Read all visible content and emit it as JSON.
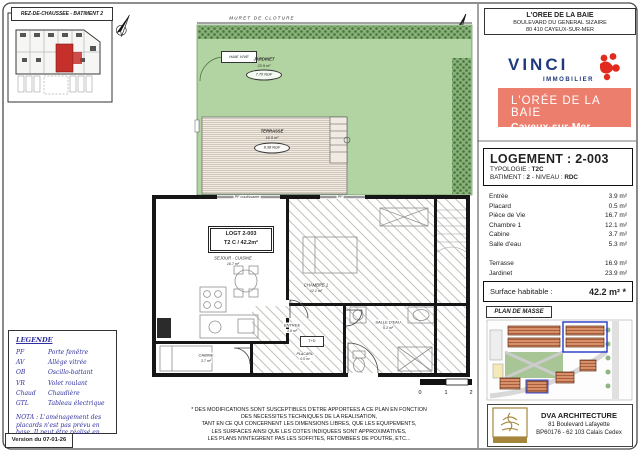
{
  "overview": {
    "title": "REZ-DE-CHAUSSEE - BATIMENT 2"
  },
  "header": {
    "address": {
      "line1": "L'OREE DE LA BAIE",
      "line2": "BOULEVARD DU GENERAL SIZAIRE",
      "line3": "80 410 CAYEUX-SUR-MER"
    },
    "vinci": {
      "name": "VINCI",
      "subtitle": "IMMOBILIER"
    },
    "banner": {
      "title": "L'ORÉE DE LA BAIE",
      "subtitle": "Cayeux-sur-Mer"
    }
  },
  "floorplan": {
    "muret": "MURET DE CLOTURE",
    "haie_vive": "HAIE VIVE",
    "jardinet": {
      "name": "JARDINET",
      "area": "23.9 m²",
      "ngf": "7.70 NGF"
    },
    "terrasse": {
      "name": "TERRASSE",
      "area": "16.9 m²",
      "ngf": "8.38 NGF"
    },
    "logt_box": {
      "line1": "LOGT 2-003",
      "line2": "T2 C / 42.2m²"
    },
    "sejour": {
      "name": "SEJOUR - CUISINE",
      "area": "16.7 m²"
    },
    "chambre": {
      "name": "CHAMBRE 1",
      "area": "12.1 m²"
    },
    "entree": {
      "name": "ENTREE",
      "area": "3.9 m²"
    },
    "placard": {
      "name": "PLACARD",
      "area": "0.5 m²"
    },
    "cabine": {
      "name": "CABINE",
      "area": "3.7 m²"
    },
    "salle_eau": {
      "name": "SALLE D'EAU",
      "area": "5.3 m²"
    },
    "tableau": "T+D",
    "pf_coulissante": "PF coulissante",
    "pf": "PF",
    "scale": [
      "0",
      "1",
      "2"
    ]
  },
  "logement": {
    "title": "LOGEMENT : 2-003",
    "typologie_label": "TYPOLOGIE : ",
    "typologie": "T2C",
    "batiment_label": "BATIMENT : ",
    "batiment": "2",
    "niveau_label": " - NIVEAU : ",
    "niveau": "RDC",
    "rooms": [
      {
        "label": "Entrée",
        "area": "3.9 m²"
      },
      {
        "label": "Placard",
        "area": "0.5 m²"
      },
      {
        "label": "Pièce de Vie",
        "area": "16.7 m²"
      },
      {
        "label": "Chambre 1",
        "area": "12.1 m²"
      },
      {
        "label": "Cabine",
        "area": "3.7 m²"
      },
      {
        "label": "Salle d'eau",
        "area": "5.3 m²"
      }
    ],
    "outdoor": [
      {
        "label": "Terrasse",
        "area": "16.9 m²"
      },
      {
        "label": "Jardinet",
        "area": "23.9 m²"
      }
    ],
    "surface_label": "Surface habitable :",
    "surface_value": "42.2 m² *"
  },
  "plan_masse": {
    "label": "PLAN DE MASSE"
  },
  "architect": {
    "name": "DVA ARCHITECTURE",
    "address1": "81 Boulevard Lafayette",
    "address2": "BP60176 - 62 103 Calais Cedex"
  },
  "legende": {
    "title": "LEGENDE",
    "items": [
      {
        "abbr": "PF",
        "label": "Porte fenêtre"
      },
      {
        "abbr": "AV",
        "label": "Allège vitrée"
      },
      {
        "abbr": "OB",
        "label": "Oscillo-battant"
      },
      {
        "abbr": "VR",
        "label": "Volet roulant"
      },
      {
        "abbr": "Chaud",
        "label": "Chaudière"
      },
      {
        "abbr": "GTL",
        "label": "Tableau électrique"
      }
    ],
    "nota": "NOTA : L'aménagement des placards n'est pas prévu en base. Il peut être réalisé en option.",
    "version": "Version du 07-01-26"
  },
  "disclaimer": [
    "* DES MODIFICATIONS SONT SUSCEPTIBLES D'ETRE APPORTEES A CE PLAN EN FONCTION",
    "DES NECESSITES TECHNIQUES DE LA REALISATION,",
    "TANT EN CE QUI CONCERNENT LES DIMENSIONS LIBRES, QUE LES EQUIPEMENTS,",
    "LES SURFACES AINSI QUE LES COTES INDIQUEES SONT APPROXIMATIVES,",
    "LES PLANS N'INTEGRENT PAS LES SOFFITES, RETOMBEES DE POUTRE, ETC..."
  ],
  "colors": {
    "banner_bg": "#ec7e6d",
    "vinci_blue": "#1e3a7b",
    "vinci_red": "#e32a1e",
    "garden_green": "#b2d4a2",
    "highlight_red": "#c5302a",
    "legend_blue": "#2e2ea0",
    "site_highlight_blue": "#2736c9",
    "architect_gold": "#a5853c"
  }
}
